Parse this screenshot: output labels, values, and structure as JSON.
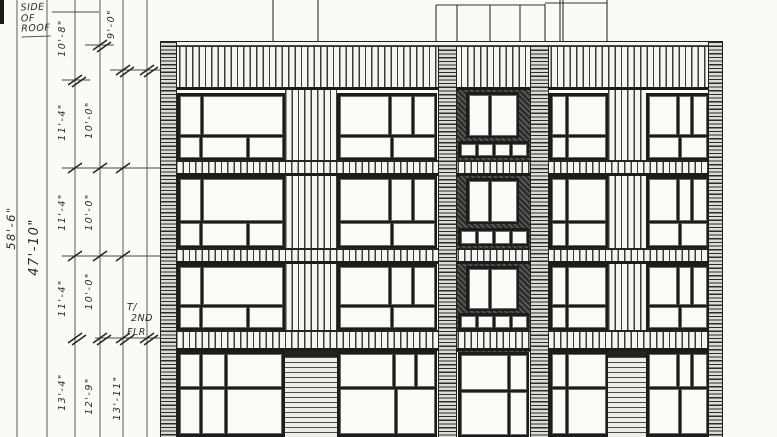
{
  "drawing": {
    "type": "hand-drawn architectural front elevation, scanned pencil sketch",
    "ink_color": "#2b2a28",
    "paper_color": "#fbfaf7"
  },
  "annotations": {
    "side_of_roof": [
      "SIDE",
      "OF",
      "ROOF"
    ],
    "floor_label": [
      "T/",
      "2ND",
      "FLR."
    ],
    "overall_dims": [
      {
        "text": "58'-6\"",
        "x": 4,
        "y": 228,
        "size": 11.5
      },
      {
        "text": "47'-10\"",
        "x": 27,
        "y": 247,
        "size": 13
      }
    ],
    "dim_strings": [
      {
        "name": "floor-to-floor-heights",
        "x": 57,
        "labels": [
          {
            "text": "10'-8\"",
            "y": 38
          },
          {
            "text": "11'-4\"",
            "y": 122
          },
          {
            "text": "11'-4\"",
            "y": 212
          },
          {
            "text": "11'-4\"",
            "y": 298
          },
          {
            "text": "13'-4\"",
            "y": 392
          }
        ]
      },
      {
        "name": "window-head-heights",
        "x": 84,
        "labels": [
          {
            "text": "10'-0\"",
            "y": 120
          },
          {
            "text": "10'-0\"",
            "y": 212
          },
          {
            "text": "10'-0\"",
            "y": 291
          },
          {
            "text": "12'-9\"",
            "y": 396
          }
        ]
      },
      {
        "name": "misc-heights",
        "x": 106,
        "labels": [
          {
            "text": "9'-0\"",
            "y": 24
          },
          {
            "text": "13'-11\"",
            "y": 398,
            "x": 112
          }
        ]
      }
    ]
  },
  "linework": {
    "dim_vlines": [
      17,
      47,
      75,
      100,
      123,
      147
    ],
    "ticks": [
      {
        "x": 100,
        "y": 45,
        "double": true
      },
      {
        "x": 123,
        "y": 70,
        "double": true
      },
      {
        "x": 147,
        "y": 70,
        "double": true
      },
      {
        "x": 75,
        "y": 80,
        "double": true
      },
      {
        "x": 75,
        "y": 168
      },
      {
        "x": 100,
        "y": 168
      },
      {
        "x": 123,
        "y": 168
      },
      {
        "x": 75,
        "y": 256
      },
      {
        "x": 100,
        "y": 256
      },
      {
        "x": 123,
        "y": 256
      },
      {
        "x": 75,
        "y": 338,
        "double": true
      },
      {
        "x": 100,
        "y": 338,
        "double": true
      },
      {
        "x": 123,
        "y": 338,
        "double": true
      },
      {
        "x": 147,
        "y": 338,
        "double": true
      }
    ],
    "connectors": [
      [
        52,
        99,
        12
      ],
      [
        85,
        114,
        45
      ],
      [
        110,
        162,
        70
      ],
      [
        62,
        90,
        80
      ],
      [
        62,
        162,
        168
      ],
      [
        62,
        162,
        256
      ],
      [
        95,
        164,
        338
      ]
    ],
    "roof_vlines": [
      [
        273,
        0
      ],
      [
        318,
        0
      ],
      [
        436,
        5
      ],
      [
        457,
        5
      ],
      [
        490,
        5
      ],
      [
        520,
        5
      ],
      [
        545,
        4
      ],
      [
        560,
        0
      ],
      [
        563,
        0
      ],
      [
        607,
        0
      ]
    ],
    "roof_hlines": [
      [
        436,
        545,
        5
      ],
      [
        545,
        607,
        3
      ]
    ]
  },
  "facade": {
    "outline": {
      "left": 160,
      "top": 42,
      "right": 723,
      "bottom": 437
    },
    "cap": {
      "y": 41,
      "h": 5
    },
    "top_band": {
      "y1": 46,
      "y2": 90
    },
    "spandrel_bands": [
      [
        160,
        176
      ],
      [
        248,
        264
      ],
      [
        330,
        351
      ]
    ],
    "rows": [
      [
        93,
        160
      ],
      [
        176,
        248
      ],
      [
        264,
        330
      ],
      [
        351,
        437
      ]
    ],
    "ladder_piers": [
      {
        "name": "left-edge-pier",
        "x1": 160,
        "x2": 177,
        "y1": 42
      },
      {
        "name": "right-edge-pier",
        "x1": 708,
        "x2": 723,
        "y1": 42
      },
      {
        "name": "stack-left-pier",
        "x1": 438,
        "x2": 457,
        "y1": 46
      },
      {
        "name": "stack-right-pier",
        "x1": 530,
        "x2": 549,
        "y1": 46
      }
    ],
    "strip_piers": [
      {
        "name": "siding-pier-1",
        "x1": 285,
        "x2": 337
      },
      {
        "name": "siding-pier-2",
        "x1": 608,
        "x2": 646
      }
    ],
    "strip_pier_slat_start": 351,
    "stack": {
      "x1": 457,
      "x2": 530,
      "fill_y1": 90,
      "fill_y2": 352,
      "win_x": [
        466,
        519
      ],
      "windows": [
        [
          92,
          138
        ],
        [
          178,
          224
        ],
        [
          266,
          311
        ]
      ],
      "rail_x": [
        458,
        529
      ],
      "rails": [
        [
          141,
          158
        ],
        [
          228,
          246
        ],
        [
          313,
          330
        ]
      ],
      "door": {
        "x1": 458,
        "x2": 529,
        "y1": 352,
        "y2": 437,
        "cols": [
          0.75,
          0.25
        ],
        "transom": 0.45
      }
    },
    "bays": [
      {
        "name": "bay-1",
        "x1": 177,
        "x2": 285,
        "cols": [
          0.2,
          0.8
        ],
        "lower": [
          0.2,
          0.46,
          0.34
        ],
        "gcols": [
          0.2,
          0.22,
          0.58
        ],
        "glower": [
          0.2,
          0.22,
          0.58
        ]
      },
      {
        "name": "bay-2",
        "x1": 337,
        "x2": 437,
        "cols": [
          0.56,
          0.22,
          0.22
        ],
        "lower": [
          0.56,
          0.44
        ],
        "gcols": [
          0.6,
          0.22,
          0.18
        ],
        "glower": [
          0.6,
          0.4
        ]
      },
      {
        "name": "bay-3",
        "x1": 549,
        "x2": 608,
        "cols": [
          0.25,
          0.75
        ],
        "lower": [
          0.25,
          0.75
        ],
        "gcols": [
          0.25,
          0.75
        ],
        "glower": [
          0.25,
          0.75
        ]
      },
      {
        "name": "bay-4",
        "x1": 646,
        "x2": 709,
        "cols": [
          0.55,
          0.2,
          0.25
        ],
        "lower": [
          0.55,
          0.45
        ],
        "gcols": [
          0.55,
          0.2,
          0.25
        ],
        "glower": [
          0.55,
          0.45
        ]
      }
    ],
    "transom_upper": 0.66,
    "transom_ground": 0.42
  }
}
